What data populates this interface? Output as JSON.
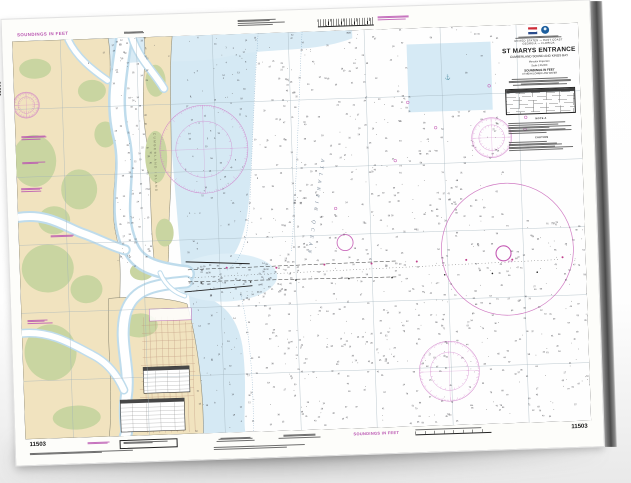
{
  "chart_number": "11503",
  "margins": {
    "top_soundings_label": "SOUNDINGS IN FEET",
    "bottom_soundings_label": "SOUNDINGS IN FEET",
    "left_chart_number": "11503",
    "bottom_left_chart_number": "11503",
    "bottom_right_chart_number": "11503"
  },
  "title_block": {
    "region_line": "UNITED STATES — EAST COAST",
    "state_line": "GEORGIA — FLORIDA",
    "title": "ST MARYS ENTRANCE",
    "subtitle": "CUMBERLAND SOUND AND KINGS BAY",
    "projection_line": "Mercator Projection",
    "scale_line": "Scale 1:25,000",
    "soundings_line": "SOUNDINGS IN FEET",
    "datum_line": "AT MEAN LOWER LOW WATER",
    "note_a_title": "NOTE A",
    "caution_title": "CAUTION"
  },
  "map_labels": {
    "ocean": "ATLANTIC OCEAN",
    "island": "CUMBERLAND ISLAND",
    "entrance_buoy": "STM"
  },
  "colors": {
    "land_tan": "#f1e3bf",
    "marsh_green": "#c9d5a1",
    "shallow_blue": "#d5e9f4",
    "compass_magenta": "#c45ab4",
    "neatline_black": "#1c1c1c"
  }
}
